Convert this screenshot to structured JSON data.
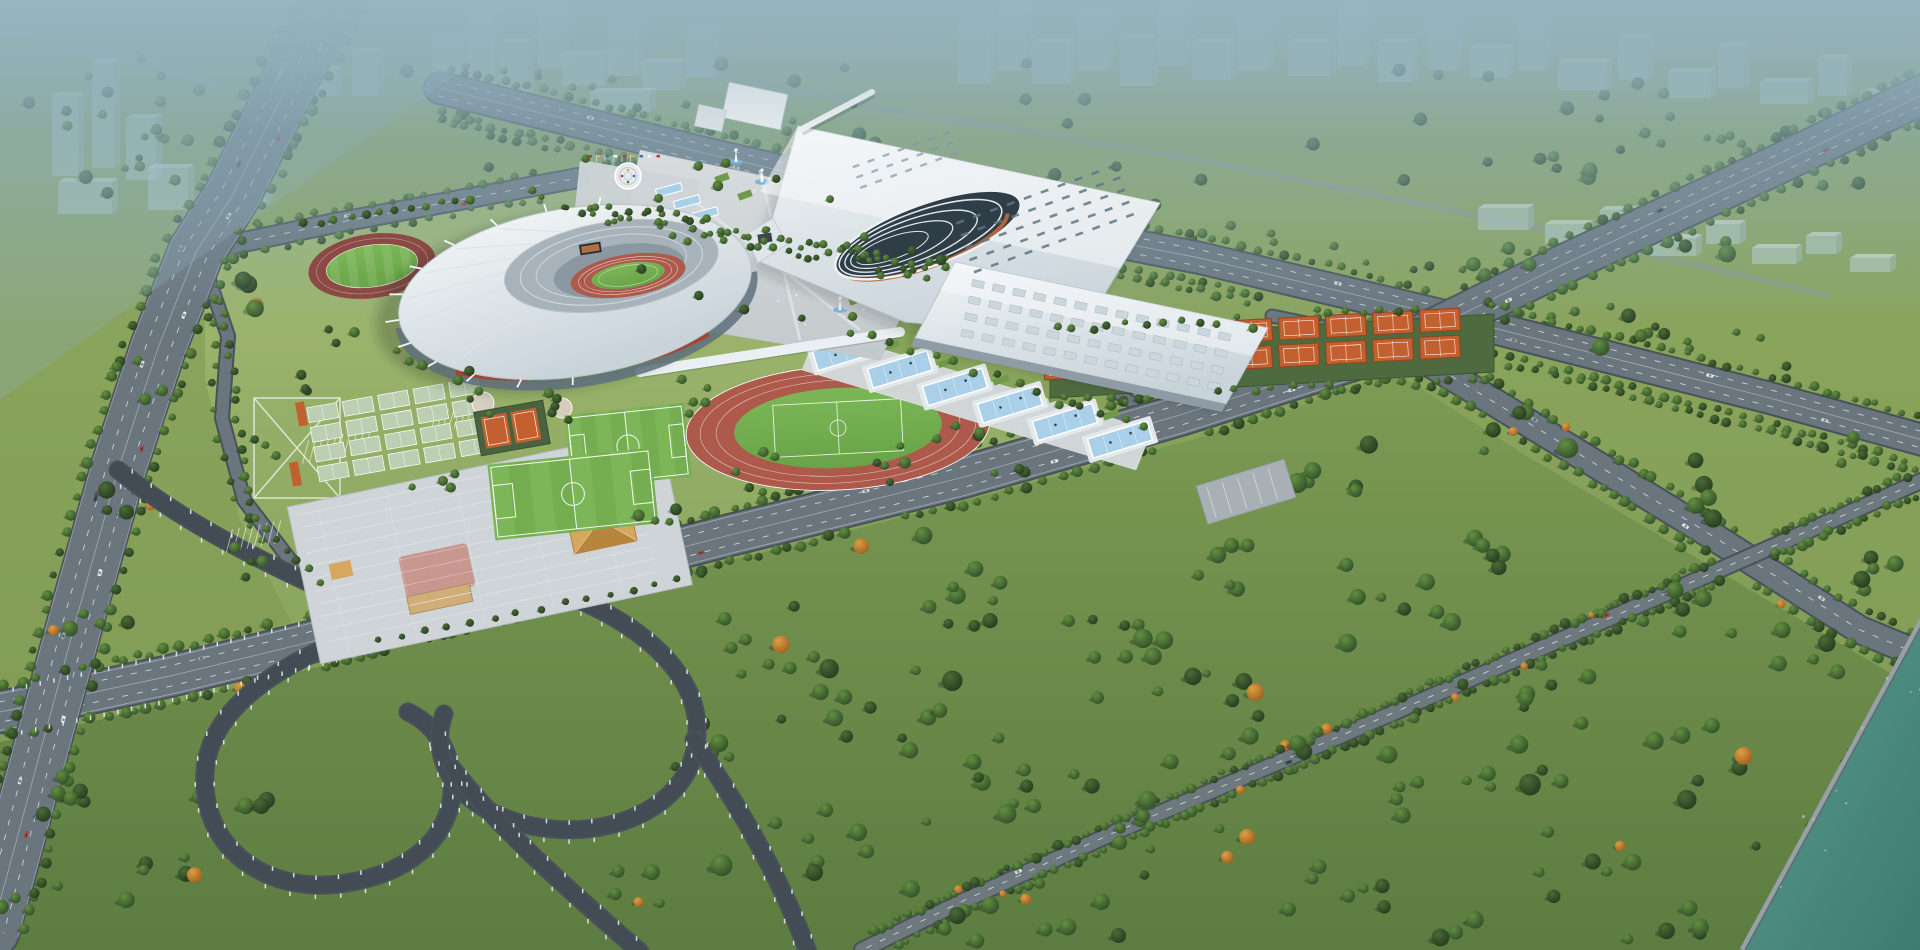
{
  "meta": {
    "image_kind": "architectural-aerial-rendering",
    "subject": "sports-complex-masterplan"
  },
  "palette": {
    "haze": "#8cabba",
    "land": "#86a258",
    "park": "#6f8e4a",
    "lawn": "#9ab26a",
    "treeDark": "#2f4c29",
    "autumn": "#c9822f",
    "roadCasing": "#49525a",
    "asphalt": "#6a757d",
    "asphaltLight": "#79848c",
    "ramp": "#434c54",
    "marking": "#eef2f4",
    "roofWhite": "#eff2f4",
    "roofShade": "#c6d1d7",
    "glass": "#76858f",
    "steel": "#9aa7b0",
    "trackRed": "#ad5a4c",
    "trackDark": "#8c4a44",
    "laneLine": "#e7cfc8",
    "pitch": "#74ae51",
    "pitchLight": "#83bd5f",
    "tennis": "#c3602f",
    "tennisDark": "#93421f",
    "courtPale": "#bccfb2",
    "pool": "#a9d0e8",
    "poolDeep": "#7fb2d6",
    "paving": "#ced4d7",
    "pavingPink": "#c69088",
    "sand": "#d7a75e",
    "sandDark": "#b8853d",
    "river": "#4b887d",
    "bank": "#99a3a8",
    "ghost": "#c3d9e3",
    "red": "#b23b2e",
    "yellow": "#e0b23e",
    "blue": "#3f6ea5",
    "white": "#f4f7f8"
  },
  "scene": {
    "features": [
      "main-stadium",
      "exhibition-hall",
      "sports-halls",
      "central-plaza-fountains",
      "practice-track",
      "running-track",
      "football-pitches",
      "tennis-courts",
      "basketball-courts",
      "water-cascade-pools",
      "parking-plaza",
      "highway",
      "avenue",
      "interchange",
      "park-forest",
      "river",
      "city-skyline"
    ]
  }
}
